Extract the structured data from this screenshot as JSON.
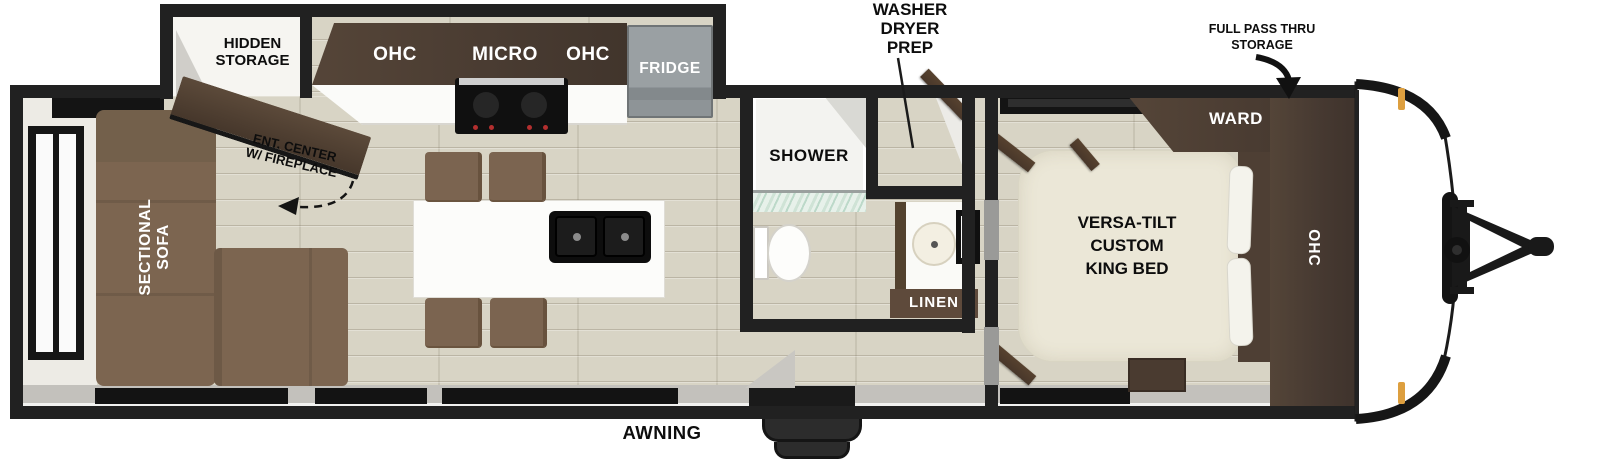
{
  "title": "Travel trailer floor plan",
  "labels": {
    "hidden_storage": [
      "HIDDEN",
      "STORAGE"
    ],
    "ent_center": [
      "ENT. CENTER",
      "W/ FIREPLACE"
    ],
    "sectional_sofa": [
      "SECTIONAL",
      "SOFA"
    ],
    "kitchen_ohc_left": "OHC",
    "micro": "MICRO",
    "kitchen_ohc_right": "OHC",
    "fridge": "FRIDGE",
    "washer_dryer_prep": [
      "WASHER",
      "DRYER",
      "PREP"
    ],
    "shower": "SHOWER",
    "linen": "LINEN",
    "full_pass_thru": [
      "FULL PASS THRU",
      "STORAGE"
    ],
    "ward": "WARD",
    "king_bed": [
      "VERSA-TILT",
      "CUSTOM",
      "KING BED"
    ],
    "bedroom_ohc": "OHC",
    "awning": "AWNING"
  },
  "colors": {
    "wall": "#212121",
    "floor": "#d8d4c5",
    "dark_wood": "#4a3c32",
    "sofa_brown": "#7c6550",
    "counter_white": "#fbfbf9",
    "fridge_gray": "#9aa0a3",
    "bed_cream": "#ebe7d7",
    "shower_glass": "#cfe3d6",
    "clearance_light_orange": "#dd9f3f",
    "sill_gray": "#c3c1bc"
  },
  "icons": {
    "full_pass_thru_arrow": "curved-arrow-down",
    "ent_center_arrow": "dashed-curved-arrow-left",
    "washer_dryer_leader": "leader-line",
    "hitch": "trailer-tongue-hitch"
  }
}
